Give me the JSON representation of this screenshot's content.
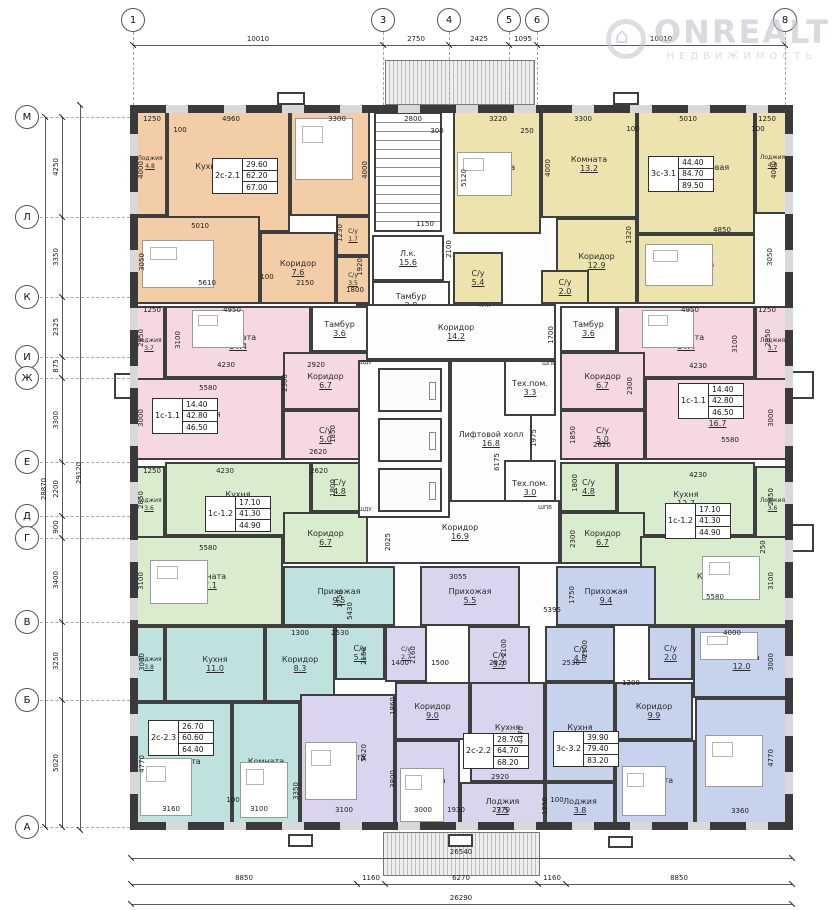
{
  "watermark": {
    "brand": "ONREALT",
    "subtitle": "НЕДВИЖИМОСТЬ"
  },
  "colors": {
    "orange": "#f2cda6",
    "yellow": "#ece3ae",
    "pink": "#f5d8e2",
    "green": "#d9ecce",
    "teal": "#bfe2df",
    "purple": "#dbd4ee",
    "blue": "#c7d2ec",
    "white": "#fdfdfd",
    "wall": "#3a3a3a"
  },
  "grid": {
    "top_axes": [
      [
        "1",
        133
      ],
      [
        "3",
        383
      ],
      [
        "4",
        449
      ],
      [
        "5",
        509
      ],
      [
        "6",
        537
      ],
      [
        "8",
        785
      ]
    ],
    "left_axes": [
      [
        "М",
        117
      ],
      [
        "Л",
        217
      ],
      [
        "К",
        297
      ],
      [
        "И",
        357
      ],
      [
        "Ж",
        378
      ],
      [
        "Е",
        462
      ],
      [
        "Д",
        516
      ],
      [
        "Г",
        538
      ],
      [
        "В",
        622
      ],
      [
        "Б",
        700
      ],
      [
        "А",
        827
      ]
    ],
    "top_dims": [
      [
        "10010",
        258
      ],
      [
        "2750",
        416
      ],
      [
        "2425",
        479
      ],
      [
        "1095",
        523
      ],
      [
        "10010",
        661
      ]
    ],
    "left_dims": [
      [
        "4250",
        167
      ],
      [
        "3350",
        257
      ],
      [
        "2325",
        327
      ],
      [
        "875",
        366
      ],
      [
        "3300",
        420
      ],
      [
        "2200",
        489
      ],
      [
        "900",
        527
      ],
      [
        "3400",
        580
      ],
      [
        "3250",
        661
      ],
      [
        "5020",
        763
      ]
    ],
    "left_overall": [
      [
        "28870",
        44,
        489
      ],
      [
        "29120",
        79,
        473
      ]
    ]
  },
  "bottom_dims": {
    "total_top": "26540",
    "chain": [
      [
        "8850",
        244
      ],
      [
        "1160",
        371
      ],
      [
        "6270",
        461
      ],
      [
        "1160",
        552
      ],
      [
        "8850",
        679
      ]
    ],
    "chain_ticks": [
      131,
      357,
      385,
      538,
      566,
      792
    ],
    "total_bottom": "26290"
  },
  "blocks": [
    [
      "2с-2.1",
      "29.60",
      "62.20",
      "67.00",
      212,
      158
    ],
    [
      "3с-3.1",
      "44.40",
      "84.70",
      "89.50",
      648,
      156
    ],
    [
      "1с-1.1",
      "14.40",
      "42.80",
      "46.50",
      152,
      398
    ],
    [
      "1с-1.1",
      "14.40",
      "42.80",
      "46.50",
      678,
      383
    ],
    [
      "1с-1.2",
      "17.10",
      "41.30",
      "44.90",
      205,
      496
    ],
    [
      "1с-1.2",
      "17.10",
      "41.30",
      "44.90",
      665,
      503
    ],
    [
      "2с-2.3",
      "26.70",
      "60.60",
      "64.40",
      148,
      720
    ],
    [
      "2с-2.2",
      "28.70",
      "64.70",
      "68.20",
      463,
      733
    ],
    [
      "3с-3.2",
      "39.90",
      "79.40",
      "83.20",
      553,
      731
    ]
  ],
  "rooms": [
    [
      "Лоджия",
      "4.8",
      133,
      110,
      34,
      106,
      "orange"
    ],
    [
      "Кухня-столовая",
      "19.8",
      167,
      110,
      123,
      122,
      "orange"
    ],
    [
      "Комната",
      "13.2",
      290,
      110,
      80,
      106,
      "orange"
    ],
    [
      "Комната",
      "16.4",
      133,
      216,
      127,
      88,
      "orange"
    ],
    [
      "Коридор",
      "7.6",
      260,
      232,
      76,
      72,
      "orange"
    ],
    [
      "С/у",
      "1.7",
      336,
      216,
      34,
      40,
      "orange"
    ],
    [
      "С/у",
      "3.5",
      336,
      256,
      34,
      48,
      "orange"
    ],
    [
      "Комната",
      "16.5",
      453,
      110,
      88,
      124,
      "yellow"
    ],
    [
      "Комната",
      "13.2",
      541,
      110,
      96,
      108,
      "yellow"
    ],
    [
      "Кухня-столовая",
      "20.0",
      637,
      110,
      118,
      124,
      "yellow"
    ],
    [
      "Лоджия",
      "4.8",
      755,
      110,
      35,
      104,
      "yellow"
    ],
    [
      "Комната",
      "14.7",
      637,
      234,
      118,
      70,
      "yellow"
    ],
    [
      "Коридор",
      "12.9",
      556,
      218,
      81,
      86,
      "yellow"
    ],
    [
      "С/у",
      "5.4",
      453,
      252,
      50,
      52,
      "yellow"
    ],
    [
      "С/у",
      "2.0",
      541,
      270,
      48,
      34,
      "yellow"
    ],
    [
      "Л.к.",
      "15.6",
      372,
      235,
      72,
      46,
      "white"
    ],
    [
      "Тамбур",
      "2.8",
      372,
      281,
      78,
      40,
      "white"
    ],
    [
      "Коридор",
      "14.2",
      356,
      304,
      200,
      56,
      "white"
    ],
    [
      "Лифтовой холл",
      "16.8",
      450,
      360,
      82,
      158,
      "white"
    ],
    [
      "Тех.пом.",
      "3.3",
      504,
      360,
      52,
      56,
      "white"
    ],
    [
      "Тех.пом.",
      "3.0",
      504,
      460,
      52,
      56,
      "white"
    ],
    [
      "Коридор",
      "16.9",
      360,
      500,
      200,
      64,
      "white"
    ],
    [
      "Тамбур",
      "3.6",
      311,
      306,
      57,
      46,
      "white"
    ],
    [
      "Тамбур",
      "3.6",
      560,
      306,
      57,
      46,
      "white"
    ],
    [
      "Лоджия",
      "3.7",
      133,
      306,
      32,
      78,
      "pink"
    ],
    [
      "Комната",
      "14.4",
      165,
      306,
      146,
      72,
      "pink"
    ],
    [
      "Коридор",
      "6.7",
      283,
      352,
      85,
      58,
      "pink"
    ],
    [
      "Кухня",
      "16.7",
      133,
      378,
      150,
      82,
      "pink"
    ],
    [
      "С/у",
      "5.0",
      283,
      410,
      85,
      50,
      "pink"
    ],
    [
      "Комната",
      "14.4",
      617,
      306,
      138,
      72,
      "pink"
    ],
    [
      "Лоджия",
      "3.7",
      755,
      306,
      35,
      78,
      "pink"
    ],
    [
      "Коридор",
      "6.7",
      560,
      352,
      85,
      58,
      "pink"
    ],
    [
      "С/у",
      "5.0",
      560,
      410,
      85,
      50,
      "pink"
    ],
    [
      "Кухня",
      "16.7",
      645,
      378,
      145,
      82,
      "pink"
    ],
    [
      "Лоджия",
      "3.6",
      133,
      466,
      32,
      78,
      "green"
    ],
    [
      "Кухня",
      "12.7",
      165,
      462,
      146,
      74,
      "green"
    ],
    [
      "С/у",
      "4.8",
      311,
      462,
      57,
      50,
      "green"
    ],
    [
      "Коридор",
      "6.7",
      283,
      512,
      85,
      52,
      "green"
    ],
    [
      "Комната",
      "17.1",
      133,
      536,
      150,
      90,
      "green"
    ],
    [
      "С/у",
      "4.8",
      560,
      462,
      57,
      50,
      "green"
    ],
    [
      "Кухня",
      "12.7",
      617,
      462,
      138,
      74,
      "green"
    ],
    [
      "Лоджия",
      "3.6",
      755,
      466,
      35,
      78,
      "green"
    ],
    [
      "Коридор",
      "6.7",
      560,
      512,
      85,
      52,
      "green"
    ],
    [
      "Комната",
      "17.1",
      640,
      536,
      150,
      90,
      "green"
    ],
    [
      "Прихожая",
      "9.5",
      283,
      566,
      112,
      60,
      "teal"
    ],
    [
      "Прихожая",
      "5.5",
      420,
      566,
      100,
      60,
      "purple"
    ],
    [
      "Прихожая",
      "9.4",
      556,
      566,
      100,
      60,
      "blue"
    ],
    [
      "Лоджия",
      "3.8",
      133,
      626,
      32,
      76,
      "teal"
    ],
    [
      "Кухня",
      "11.0",
      165,
      626,
      100,
      76,
      "teal"
    ],
    [
      "Коридор",
      "8.3",
      265,
      626,
      70,
      76,
      "teal"
    ],
    [
      "С/у",
      "5.1",
      335,
      626,
      50,
      54,
      "teal"
    ],
    [
      "Комната",
      "16.3",
      133,
      702,
      99,
      128,
      "teal"
    ],
    [
      "Комната",
      "10.4",
      232,
      702,
      68,
      128,
      "teal"
    ],
    [
      "С/у",
      "2.7",
      385,
      626,
      42,
      56,
      "purple"
    ],
    [
      "С/у",
      "5.7",
      468,
      626,
      62,
      68,
      "purple"
    ],
    [
      "Коридор",
      "9.0",
      395,
      682,
      75,
      58,
      "purple"
    ],
    [
      "Кухня",
      "13.1",
      470,
      682,
      75,
      100,
      "purple"
    ],
    [
      "Комната",
      "17.3",
      300,
      694,
      95,
      136,
      "purple"
    ],
    [
      "Комната",
      "11.4",
      395,
      740,
      65,
      90,
      "purple"
    ],
    [
      "Лоджия",
      "3.5",
      460,
      782,
      85,
      48,
      "purple"
    ],
    [
      "С/у",
      "4.8",
      545,
      626,
      70,
      56,
      "blue"
    ],
    [
      "С/у",
      "2.0",
      648,
      626,
      45,
      54,
      "blue"
    ],
    [
      "Комната",
      "12.0",
      693,
      626,
      97,
      72,
      "blue"
    ],
    [
      "Коридор",
      "9.9",
      615,
      682,
      78,
      58,
      "blue"
    ],
    [
      "Кухня",
      "13.4",
      545,
      682,
      70,
      100,
      "blue"
    ],
    [
      "Комната",
      "11.1",
      615,
      740,
      80,
      90,
      "blue"
    ],
    [
      "Комната",
      "16.8",
      695,
      698,
      95,
      132,
      "blue"
    ],
    [
      "Лоджия",
      "3.8",
      545,
      782,
      70,
      48,
      "blue"
    ]
  ],
  "dims": [
    [
      "1250",
      152,
      119
    ],
    [
      "4960",
      231,
      119
    ],
    [
      "100",
      180,
      130
    ],
    [
      "3300",
      337,
      119
    ],
    [
      "2800",
      413,
      119
    ],
    [
      "300",
      437,
      131
    ],
    [
      "3220",
      498,
      119
    ],
    [
      "250",
      527,
      131
    ],
    [
      "3300",
      583,
      119
    ],
    [
      "100",
      633,
      129
    ],
    [
      "5010",
      688,
      119
    ],
    [
      "1250",
      767,
      119
    ],
    [
      "100",
      758,
      129
    ],
    [
      "4000",
      141,
      170,
      1
    ],
    [
      "4000",
      365,
      170,
      1
    ],
    [
      "4000",
      548,
      168,
      1
    ],
    [
      "4000",
      774,
      170,
      1
    ],
    [
      "5120",
      464,
      178,
      1
    ],
    [
      "5010",
      200,
      226
    ],
    [
      "3050",
      142,
      262,
      1
    ],
    [
      "1230",
      340,
      233,
      1
    ],
    [
      "1920",
      360,
      267,
      1
    ],
    [
      "5610",
      207,
      283
    ],
    [
      "100",
      267,
      277
    ],
    [
      "2150",
      305,
      283
    ],
    [
      "1800",
      355,
      290
    ],
    [
      "1150",
      425,
      224
    ],
    [
      "2100",
      449,
      249,
      1
    ],
    [
      "1320",
      629,
      235,
      1
    ],
    [
      "4850",
      722,
      230
    ],
    [
      "3050",
      770,
      257,
      1
    ],
    [
      "1250",
      152,
      310
    ],
    [
      "4950",
      232,
      310
    ],
    [
      "2950",
      141,
      338,
      1
    ],
    [
      "3100",
      178,
      340,
      1
    ],
    [
      "4230",
      226,
      365
    ],
    [
      "2920",
      316,
      365
    ],
    [
      "2300",
      285,
      383,
      1
    ],
    [
      "5580",
      208,
      388
    ],
    [
      "3000",
      141,
      418,
      1
    ],
    [
      "1850",
      333,
      434,
      1
    ],
    [
      "2620",
      318,
      452
    ],
    [
      "4950",
      690,
      310
    ],
    [
      "1250",
      767,
      310
    ],
    [
      "2950",
      768,
      338,
      1
    ],
    [
      "3100",
      735,
      344,
      1
    ],
    [
      "4230",
      698,
      366
    ],
    [
      "2300",
      630,
      386,
      1
    ],
    [
      "5580",
      730,
      440
    ],
    [
      "3000",
      771,
      418,
      1
    ],
    [
      "1850",
      573,
      435,
      1
    ],
    [
      "2620",
      602,
      445
    ],
    [
      "1700",
      551,
      335,
      1
    ],
    [
      "1975",
      534,
      438,
      1
    ],
    [
      "6175",
      497,
      462,
      1
    ],
    [
      "1800",
      575,
      483,
      1
    ],
    [
      "2025",
      388,
      542,
      1
    ],
    [
      "3055",
      458,
      577
    ],
    [
      "1750",
      572,
      595,
      1
    ],
    [
      "5395",
      552,
      610
    ],
    [
      "2300",
      573,
      539,
      1
    ],
    [
      "1250",
      152,
      471
    ],
    [
      "4230",
      225,
      471
    ],
    [
      "2620",
      319,
      471
    ],
    [
      "2850",
      141,
      500,
      1
    ],
    [
      "5580",
      208,
      548
    ],
    [
      "3100",
      141,
      581,
      1
    ],
    [
      "1800",
      333,
      488,
      1
    ],
    [
      "1750",
      340,
      599,
      1
    ],
    [
      "5430",
      350,
      611,
      1
    ],
    [
      "4230",
      698,
      475
    ],
    [
      "2850",
      771,
      497,
      1
    ],
    [
      "3100",
      771,
      581,
      1
    ],
    [
      "5580",
      715,
      597
    ],
    [
      "250",
      763,
      547,
      1
    ],
    [
      "3000",
      142,
      662,
      1
    ],
    [
      "1300",
      300,
      633
    ],
    [
      "2530",
      340,
      633
    ],
    [
      "2150",
      364,
      656,
      1
    ],
    [
      "2160",
      413,
      655,
      1
    ],
    [
      "1400",
      400,
      663
    ],
    [
      "1500",
      440,
      663
    ],
    [
      "2920",
      498,
      663
    ],
    [
      "2100",
      504,
      648,
      1
    ],
    [
      "2530",
      571,
      663
    ],
    [
      "2100",
      585,
      649,
      1
    ],
    [
      "1200",
      631,
      683
    ],
    [
      "4000",
      732,
      633
    ],
    [
      "3000",
      771,
      662,
      1
    ],
    [
      "4770",
      142,
      764,
      1
    ],
    [
      "3160",
      171,
      809
    ],
    [
      "100",
      233,
      800
    ],
    [
      "3100",
      259,
      809
    ],
    [
      "3350",
      296,
      791,
      1
    ],
    [
      "5620",
      364,
      753,
      1
    ],
    [
      "1860",
      393,
      706,
      1
    ],
    [
      "3800",
      393,
      779,
      1
    ],
    [
      "3100",
      344,
      810
    ],
    [
      "3000",
      423,
      810
    ],
    [
      "1930",
      456,
      810
    ],
    [
      "2770",
      501,
      810
    ],
    [
      "2920",
      500,
      777
    ],
    [
      "4470",
      521,
      735,
      1
    ],
    [
      "4770",
      771,
      758,
      1
    ],
    [
      "1250",
      545,
      806,
      1
    ],
    [
      "3360",
      740,
      811
    ],
    [
      "100",
      557,
      800
    ]
  ],
  "tiny_labels": [
    [
      "КТП",
      485,
      306
    ],
    [
      "ШДУ",
      365,
      363
    ],
    [
      "ШДУ",
      365,
      510
    ],
    [
      "ШПВ",
      549,
      364
    ],
    [
      "ШПВ",
      545,
      508
    ]
  ],
  "features": {
    "stairs": [
      374,
      112,
      68,
      120
    ],
    "shaft": [
      358,
      360,
      92,
      158
    ],
    "elevators": [
      [
        378,
        368,
        64,
        44
      ],
      [
        378,
        418,
        64,
        44
      ],
      [
        378,
        468,
        64,
        44
      ]
    ],
    "canopy_top": [
      385,
      60,
      150,
      45
    ],
    "canopy_bottom": [
      383,
      832,
      157,
      44
    ],
    "top_boxes": [
      [
        277,
        92,
        28,
        13
      ],
      [
        613,
        92,
        26,
        13
      ]
    ],
    "bottom_boxes": [
      [
        288,
        834,
        25,
        13
      ],
      [
        448,
        834,
        25,
        13
      ],
      [
        608,
        836,
        25,
        12
      ]
    ],
    "bays": [
      [
        114,
        373,
        18,
        26
      ],
      [
        790,
        371,
        24,
        28
      ],
      [
        790,
        524,
        24,
        28
      ]
    ],
    "beds": [
      [
        295,
        118,
        58,
        62
      ],
      [
        142,
        240,
        72,
        48
      ],
      [
        457,
        152,
        55,
        44
      ],
      [
        645,
        244,
        68,
        42
      ],
      [
        192,
        310,
        52,
        38
      ],
      [
        642,
        310,
        52,
        38
      ],
      [
        150,
        560,
        58,
        44
      ],
      [
        702,
        556,
        58,
        44
      ],
      [
        140,
        758,
        52,
        58
      ],
      [
        240,
        762,
        48,
        56
      ],
      [
        305,
        742,
        52,
        58
      ],
      [
        400,
        768,
        44,
        54
      ],
      [
        705,
        735,
        58,
        52
      ],
      [
        700,
        632,
        58,
        28
      ],
      [
        622,
        766,
        44,
        50
      ]
    ]
  }
}
